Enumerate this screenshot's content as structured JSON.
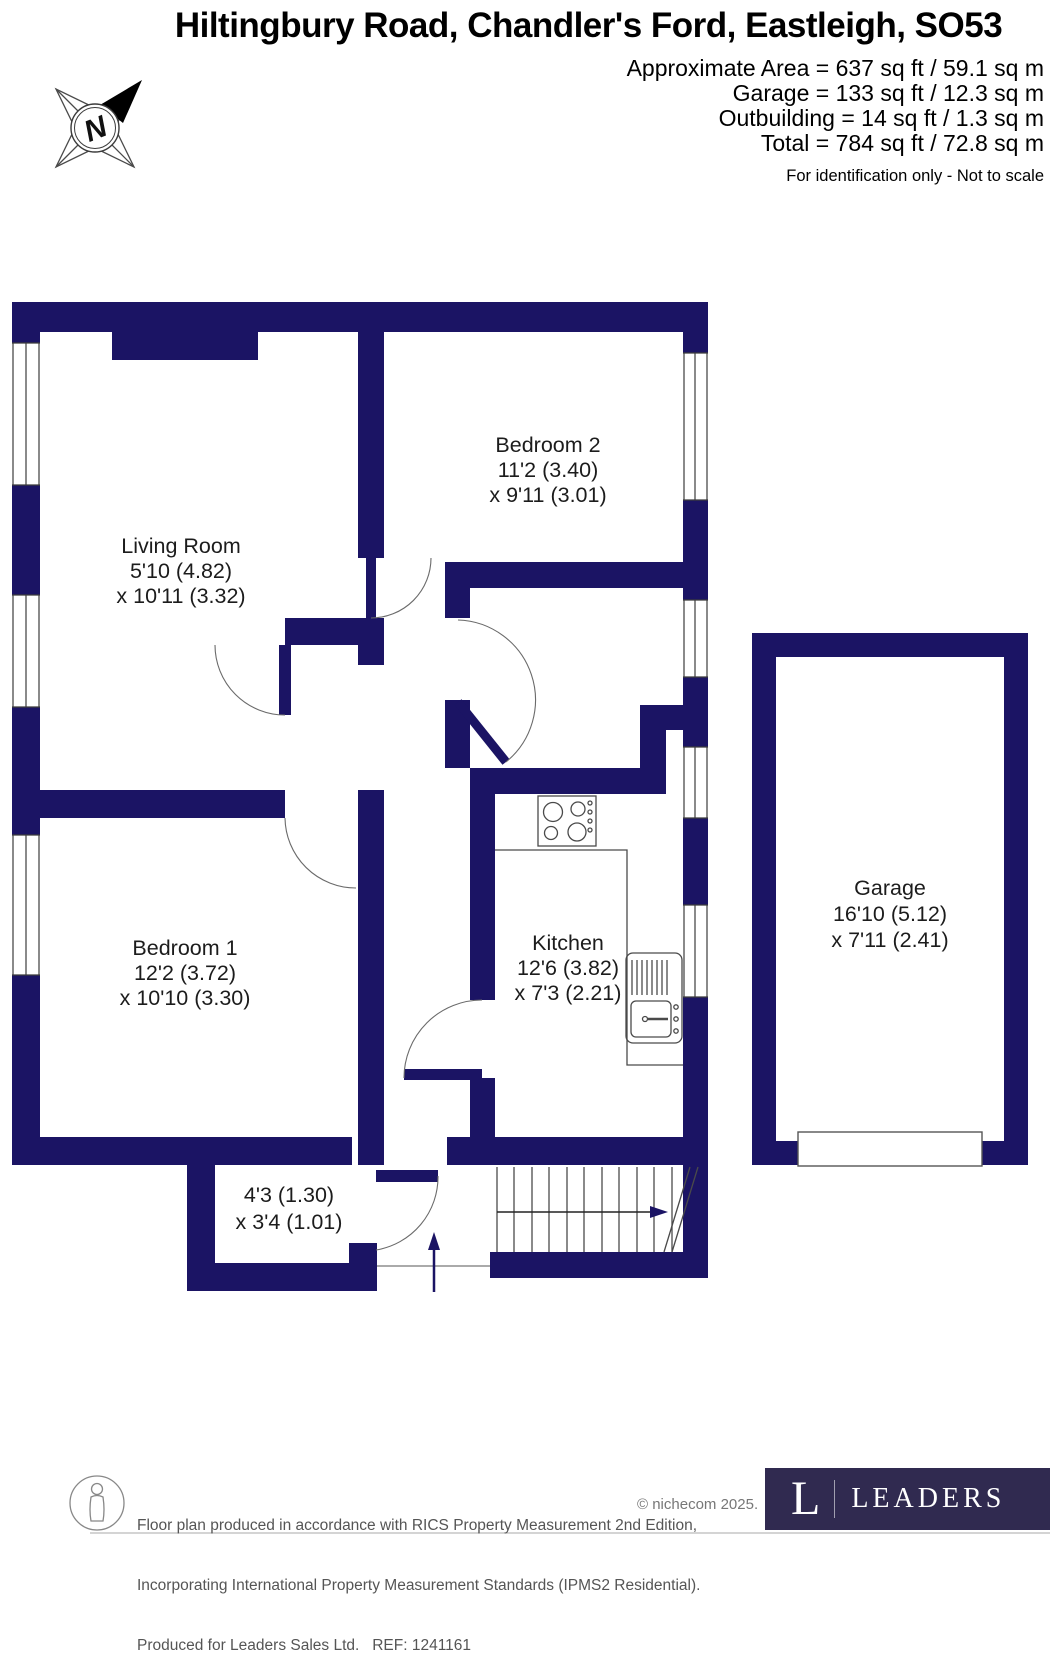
{
  "header": {
    "title": "Hiltingbury Road, Chandler's Ford, Eastleigh, SO53",
    "area_lines": [
      "Approximate Area = 637 sq ft / 59.1 sq m",
      "Garage = 133 sq ft / 12.3 sq m",
      "Outbuilding = 14 sq ft / 1.3 sq m",
      "Total = 784 sq ft / 72.8 sq m"
    ],
    "disclaimer": "For identification only - Not to scale"
  },
  "compass": {
    "label": "N"
  },
  "rooms": {
    "living_room": {
      "name": "Living Room",
      "dim1": "5'10 (4.82)",
      "dim2": "x 10'11 (3.32)"
    },
    "bedroom2": {
      "name": "Bedroom 2",
      "dim1": "11'2 (3.40)",
      "dim2": "x 9'11 (3.01)"
    },
    "bedroom1": {
      "name": "Bedroom 1",
      "dim1": "12'2 (3.72)",
      "dim2": "x 10'10 (3.30)"
    },
    "kitchen": {
      "name": "Kitchen",
      "dim1": "12'6 (3.82)",
      "dim2": "x 7'3 (2.21)"
    },
    "garage": {
      "name": "Garage",
      "dim1": "16'10 (5.12)",
      "dim2": "x 7'11 (2.41)"
    },
    "porch": {
      "dim1": "4'3 (1.30)",
      "dim2": "x 3'4 (1.01)"
    }
  },
  "footer": {
    "line1": "Floor plan produced in accordance with RICS Property Measurement 2nd Edition,",
    "line2": "Incorporating International Property Measurement Standards (IPMS2 Residential).",
    "line3": "Produced for Leaders Sales Ltd.   REF: 1241161",
    "copyright": "© nichecom 2025.",
    "logo": {
      "letter": "L",
      "brand": "LEADERS"
    }
  },
  "colors": {
    "wall": "#1b1464",
    "logo_bg": "#302a50",
    "text": "#000000",
    "footer_text": "#555555"
  }
}
